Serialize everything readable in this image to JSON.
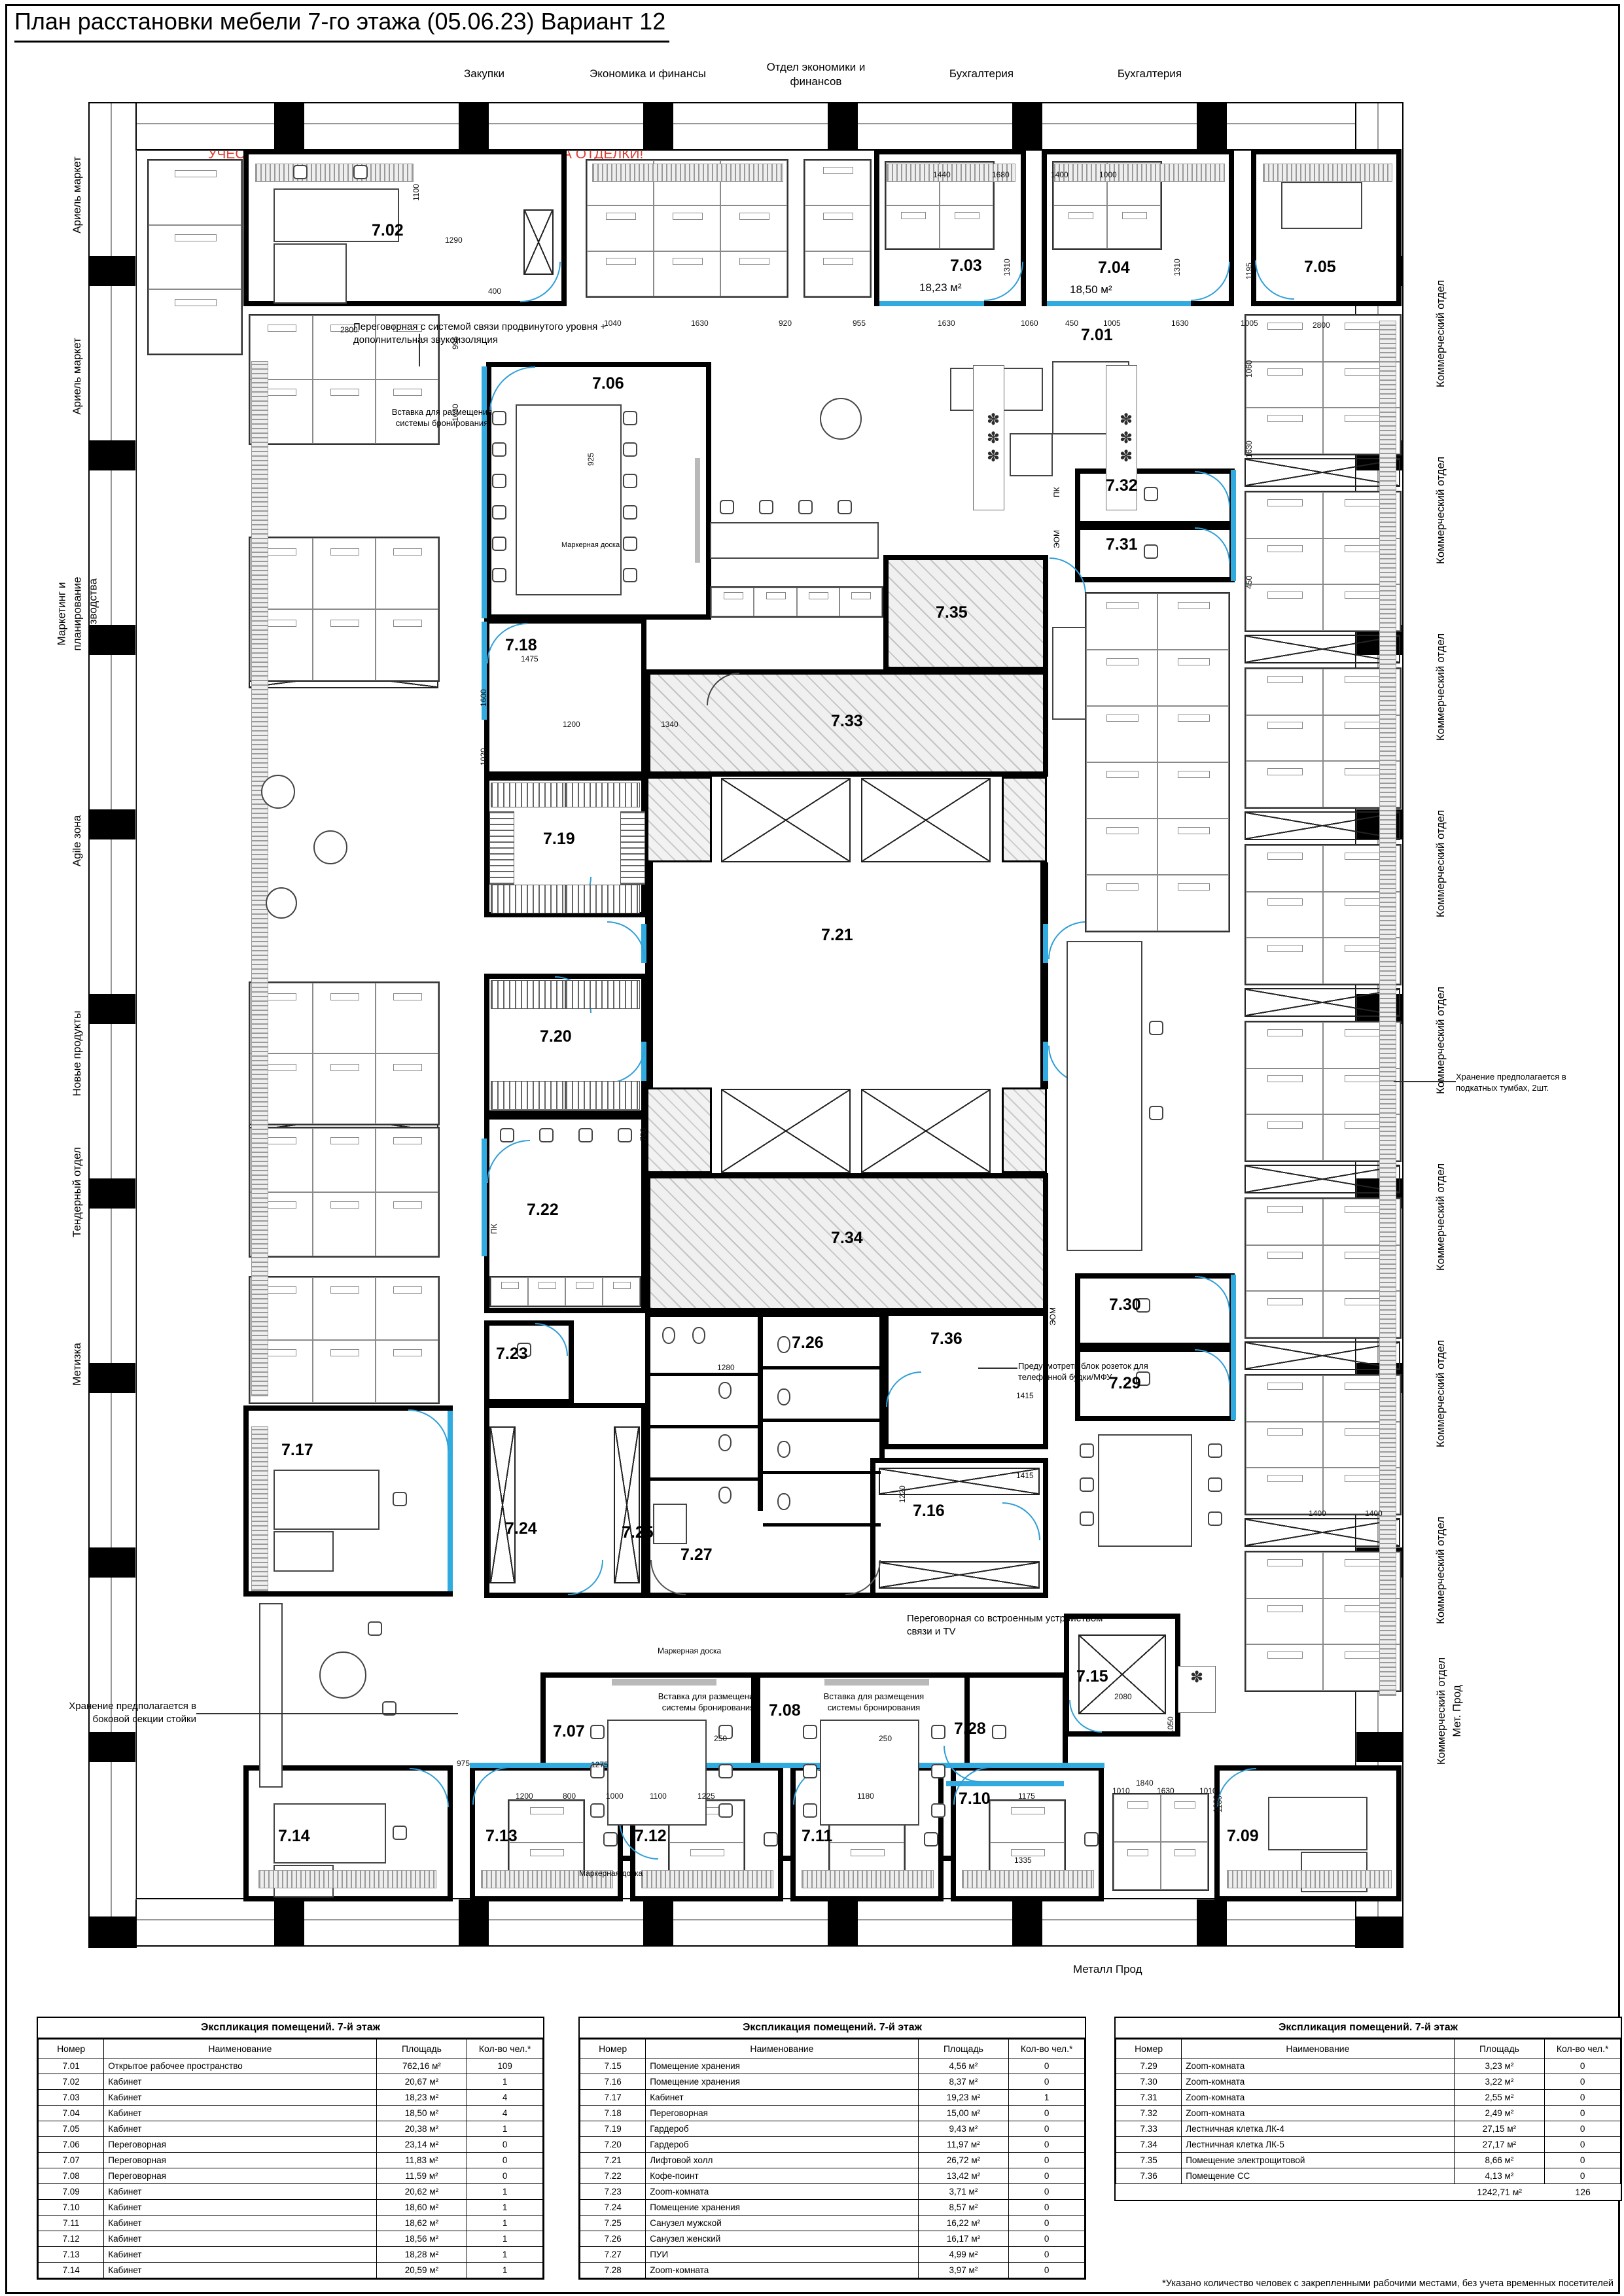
{
  "title": "План расстановки мебели 7-го этажа (05.06.23) Вариант 12",
  "warning": "УЧЕСТЬ, ЧТО РАЗМЕРЫ ПРОХОДОВ ДАНЫ БЕЗ УЧЕТА ОТДЕЛКИ!",
  "plan": {
    "top_labels": [
      [
        "Закупки"
      ],
      [
        "Экономика и финансы"
      ],
      [
        "Отдел экономики и",
        "финансов"
      ],
      [
        "Бухгалтерия"
      ],
      [
        "Бухгалтерия"
      ]
    ],
    "left_labels": [
      [
        "Ариель маркет"
      ],
      [
        "Ариель маркет"
      ],
      [
        "Маркетинг и",
        "планирование",
        "производства"
      ],
      [
        "Agile зона"
      ],
      [
        "Новые продукты"
      ],
      [
        "Тендерный отдел"
      ],
      [
        "Метизка"
      ]
    ],
    "right_labels": [
      [
        "Коммерческий отдел"
      ],
      [
        "Коммерческий отдел"
      ],
      [
        "Коммерческий отдел"
      ],
      [
        "Коммерческий отдел"
      ],
      [
        "Коммерческий отдел"
      ],
      [
        "Коммерческий отдел"
      ],
      [
        "Коммерческий отдел"
      ],
      [
        "Коммерческий отдел"
      ],
      [
        "Коммерческий отдел",
        "Мет. Прод"
      ]
    ],
    "bottom_label": "Металл Прод",
    "rooms": [
      "7.01",
      "7.02",
      "7.03",
      "7.04",
      "7.05",
      "7.06",
      "7.07",
      "7.08",
      "7.09",
      "7.10",
      "7.11",
      "7.12",
      "7.13",
      "7.14",
      "7.15",
      "7.16",
      "7.17",
      "7.18",
      "7.19",
      "7.20",
      "7.21",
      "7.22",
      "7.23",
      "7.24",
      "7.25",
      "7.26",
      "7.27",
      "7.28",
      "7.29",
      "7.30",
      "7.31",
      "7.32",
      "7.33",
      "7.34",
      "7.35",
      "7.36"
    ],
    "room_areas": [
      "18,23 м²",
      "18,50 м²"
    ],
    "annotations": [
      [
        "Переговорная с системой связи продвинутого уровня +",
        "дополнительная звукоизоляция"
      ],
      [
        "Вставка для размещения",
        "системы бронирования"
      ],
      [
        "Вставка для размещения",
        "системы бронирования"
      ],
      [
        "Вставка для размещения",
        "системы бронирования"
      ],
      [
        "Хранение предполагается в",
        "подкатных тумбах, 2шт."
      ],
      [
        "Хранение предполагается в",
        "боковой секции стойки"
      ],
      [
        "Предусмотреть блок розеток для",
        "телефонной будки/МФУ"
      ],
      [
        "Переговорная со встроенным устройством",
        "связи и TV"
      ],
      [
        "Маркерная доска"
      ],
      [
        "Маркерная доска"
      ],
      [
        "Маркерная доска"
      ],
      [
        "ПК"
      ],
      [
        "ПК"
      ],
      [
        "ЭОМ"
      ],
      [
        "ЭОМ"
      ]
    ],
    "dims": [
      "2800",
      "995",
      "1630",
      "1100",
      "1290",
      "400",
      "1040",
      "1630",
      "920",
      "955",
      "1630",
      "1060",
      "450",
      "1005",
      "1630",
      "1005",
      "1440",
      "1680",
      "1400",
      "1000",
      "1310",
      "1310",
      "1195",
      "2800",
      "1060",
      "1630",
      "450",
      "925",
      "1200",
      "1340",
      "1475",
      "1600",
      "1020",
      "700",
      "1280",
      "1415",
      "1415",
      "1220",
      "2080",
      "1050",
      "1840",
      "1000",
      "1335",
      "1200",
      "800",
      "1000",
      "1100",
      "1225",
      "1180",
      "1175",
      "1010",
      "1630",
      "1010",
      "250",
      "250",
      "1400",
      "1400",
      "1130",
      "1275",
      "975"
    ]
  },
  "tables": [
    {
      "title": "Экспликация помещений. 7-й этаж",
      "headers": [
        "Номер",
        "Наименование",
        "Площадь",
        "Кол-во чел.*"
      ],
      "rows": [
        [
          "7.01",
          "Открытое рабочее пространство",
          "762,16 м²",
          "109"
        ],
        [
          "7.02",
          "Кабинет",
          "20,67 м²",
          "1"
        ],
        [
          "7.03",
          "Кабинет",
          "18,23 м²",
          "4"
        ],
        [
          "7.04",
          "Кабинет",
          "18,50 м²",
          "4"
        ],
        [
          "7.05",
          "Кабинет",
          "20,38 м²",
          "1"
        ],
        [
          "7.06",
          "Переговорная",
          "23,14 м²",
          "0"
        ],
        [
          "7.07",
          "Переговорная",
          "11,83 м²",
          "0"
        ],
        [
          "7.08",
          "Переговорная",
          "11,59 м²",
          "0"
        ],
        [
          "7.09",
          "Кабинет",
          "20,62 м²",
          "1"
        ],
        [
          "7.10",
          "Кабинет",
          "18,60 м²",
          "1"
        ],
        [
          "7.11",
          "Кабинет",
          "18,62 м²",
          "1"
        ],
        [
          "7.12",
          "Кабинет",
          "18,56 м²",
          "1"
        ],
        [
          "7.13",
          "Кабинет",
          "18,28 м²",
          "1"
        ],
        [
          "7.14",
          "Кабинет",
          "20,59 м²",
          "1"
        ]
      ]
    },
    {
      "title": "Экспликация помещений. 7-й этаж",
      "headers": [
        "Номер",
        "Наименование",
        "Площадь",
        "Кол-во чел.*"
      ],
      "rows": [
        [
          "7.15",
          "Помещение хранения",
          "4,56 м²",
          "0"
        ],
        [
          "7.16",
          "Помещение хранения",
          "8,37 м²",
          "0"
        ],
        [
          "7.17",
          "Кабинет",
          "19,23 м²",
          "1"
        ],
        [
          "7.18",
          "Переговорная",
          "15,00 м²",
          "0"
        ],
        [
          "7.19",
          "Гардероб",
          "9,43 м²",
          "0"
        ],
        [
          "7.20",
          "Гардероб",
          "11,97 м²",
          "0"
        ],
        [
          "7.21",
          "Лифтовой холл",
          "26,72 м²",
          "0"
        ],
        [
          "7.22",
          "Кофе-поинт",
          "13,42 м²",
          "0"
        ],
        [
          "7.23",
          "Zoom-комната",
          "3,71 м²",
          "0"
        ],
        [
          "7.24",
          "Помещение хранения",
          "8,57 м²",
          "0"
        ],
        [
          "7.25",
          "Санузел мужской",
          "16,22 м²",
          "0"
        ],
        [
          "7.26",
          "Санузел женский",
          "16,17 м²",
          "0"
        ],
        [
          "7.27",
          "ПУИ",
          "4,99 м²",
          "0"
        ],
        [
          "7.28",
          "Zoom-комната",
          "3,97 м²",
          "0"
        ]
      ]
    },
    {
      "title": "Экспликация помещений. 7-й этаж",
      "headers": [
        "Номер",
        "Наименование",
        "Площадь",
        "Кол-во чел.*"
      ],
      "rows": [
        [
          "7.29",
          "Zoom-комната",
          "3,23 м²",
          "0"
        ],
        [
          "7.30",
          "Zoom-комната",
          "3,22 м²",
          "0"
        ],
        [
          "7.31",
          "Zoom-комната",
          "2,55 м²",
          "0"
        ],
        [
          "7.32",
          "Zoom-комната",
          "2,49 м²",
          "0"
        ],
        [
          "7.33",
          "Лестничная клетка ЛК-4",
          "27,15 м²",
          "0"
        ],
        [
          "7.34",
          "Лестничная клетка ЛК-5",
          "27,17 м²",
          "0"
        ],
        [
          "7.35",
          "Помещение электрощитовой",
          "8,66 м²",
          "0"
        ],
        [
          "7.36",
          "Помещение СС",
          "4,13 м²",
          "0"
        ]
      ],
      "totals": [
        "1242,71 м²",
        "126"
      ]
    }
  ],
  "footnote": "*Указано количество человек с закрепленными рабочими местами, без учета временных посетителей"
}
